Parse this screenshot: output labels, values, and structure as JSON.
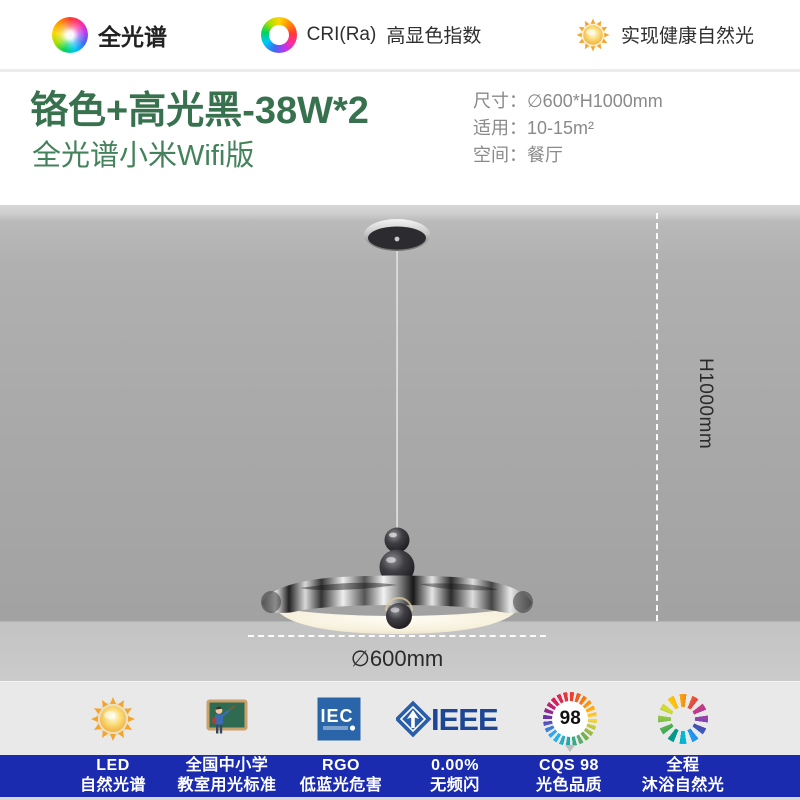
{
  "top_bar": {
    "items": [
      {
        "icon": "spectrum-wheel-icon",
        "label": "全光谱"
      },
      {
        "icon": "cri-ring-icon",
        "label": "CRI(Ra)",
        "sublabel": "高显色指数"
      },
      {
        "icon": "sun-icon",
        "label": "实现健康自然光"
      }
    ]
  },
  "header": {
    "title": "铬色+高光黑-38W*2",
    "subtitle": "全光谱小米Wifi版",
    "specs": [
      {
        "label": "尺寸：",
        "value": "∅600*H1000mm"
      },
      {
        "label": "适用：",
        "value": "10-15m²"
      },
      {
        "label": "空间：",
        "value": "餐厅"
      }
    ]
  },
  "stage": {
    "height_label": "H1000mm",
    "diameter_label": "∅600mm"
  },
  "footer": {
    "badges": [
      {
        "icon": "sun-icon",
        "line1": "LED",
        "line2": "自然光谱"
      },
      {
        "icon": "classroom-icon",
        "line1": "全国中小学",
        "line2": "教室用光标准"
      },
      {
        "icon": "iec-logo",
        "logo": "IEC",
        "line1": "RGO",
        "line2": "低蓝光危害"
      },
      {
        "icon": "ieee-logo",
        "logo": "IEEE",
        "line1": "0.00%",
        "line2": "无频闪"
      },
      {
        "icon": "cqs-badge",
        "value": "98",
        "line1": "CQS 98",
        "line2": "光色品质"
      },
      {
        "icon": "spectrum-spinner-icon",
        "line1": "全程",
        "line2": "沐浴自然光"
      }
    ]
  },
  "colors": {
    "title_green": "#37714e",
    "subtitle_green": "#44825c",
    "band_blue": "#1b2bb0",
    "spec_gray": "#8a8a8a",
    "wall_gray": "#a9a9a9",
    "ieee_blue": "#1d4795",
    "iec_blue": "#2a64a9"
  }
}
